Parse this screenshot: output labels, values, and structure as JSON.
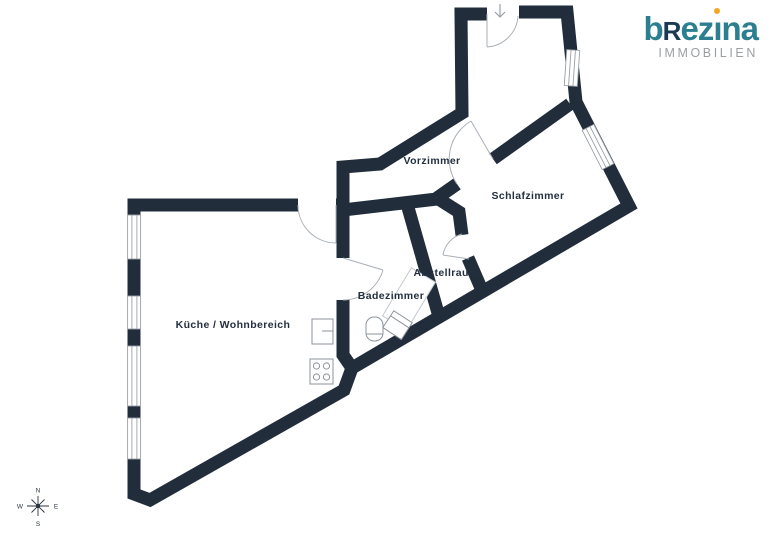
{
  "logo": {
    "b": "b",
    "r": "R",
    "ez": "ez",
    "i_dotless": "ı",
    "na": "na",
    "subtitle": "IMMOBILIEN"
  },
  "rooms": {
    "vorzimmer": "Vorzimmer",
    "schlafzimmer": "Schlafzimmer",
    "abstellraum": "Abstellraum",
    "badezimmer": "Badezimmer",
    "kueche_wohnbereich": "Küche / Wohnbereich"
  },
  "compass": {
    "n": "N",
    "s": "S",
    "w": "W",
    "e": "E"
  },
  "colors": {
    "wall": "#212d3b",
    "label_text": "#243040",
    "logo_teal": "#2c7f91",
    "logo_navy": "#1b3a52",
    "logo_orange": "#f5a623",
    "logo_gray": "#9b9fa3",
    "thin_lines": "#a8aeb5"
  }
}
